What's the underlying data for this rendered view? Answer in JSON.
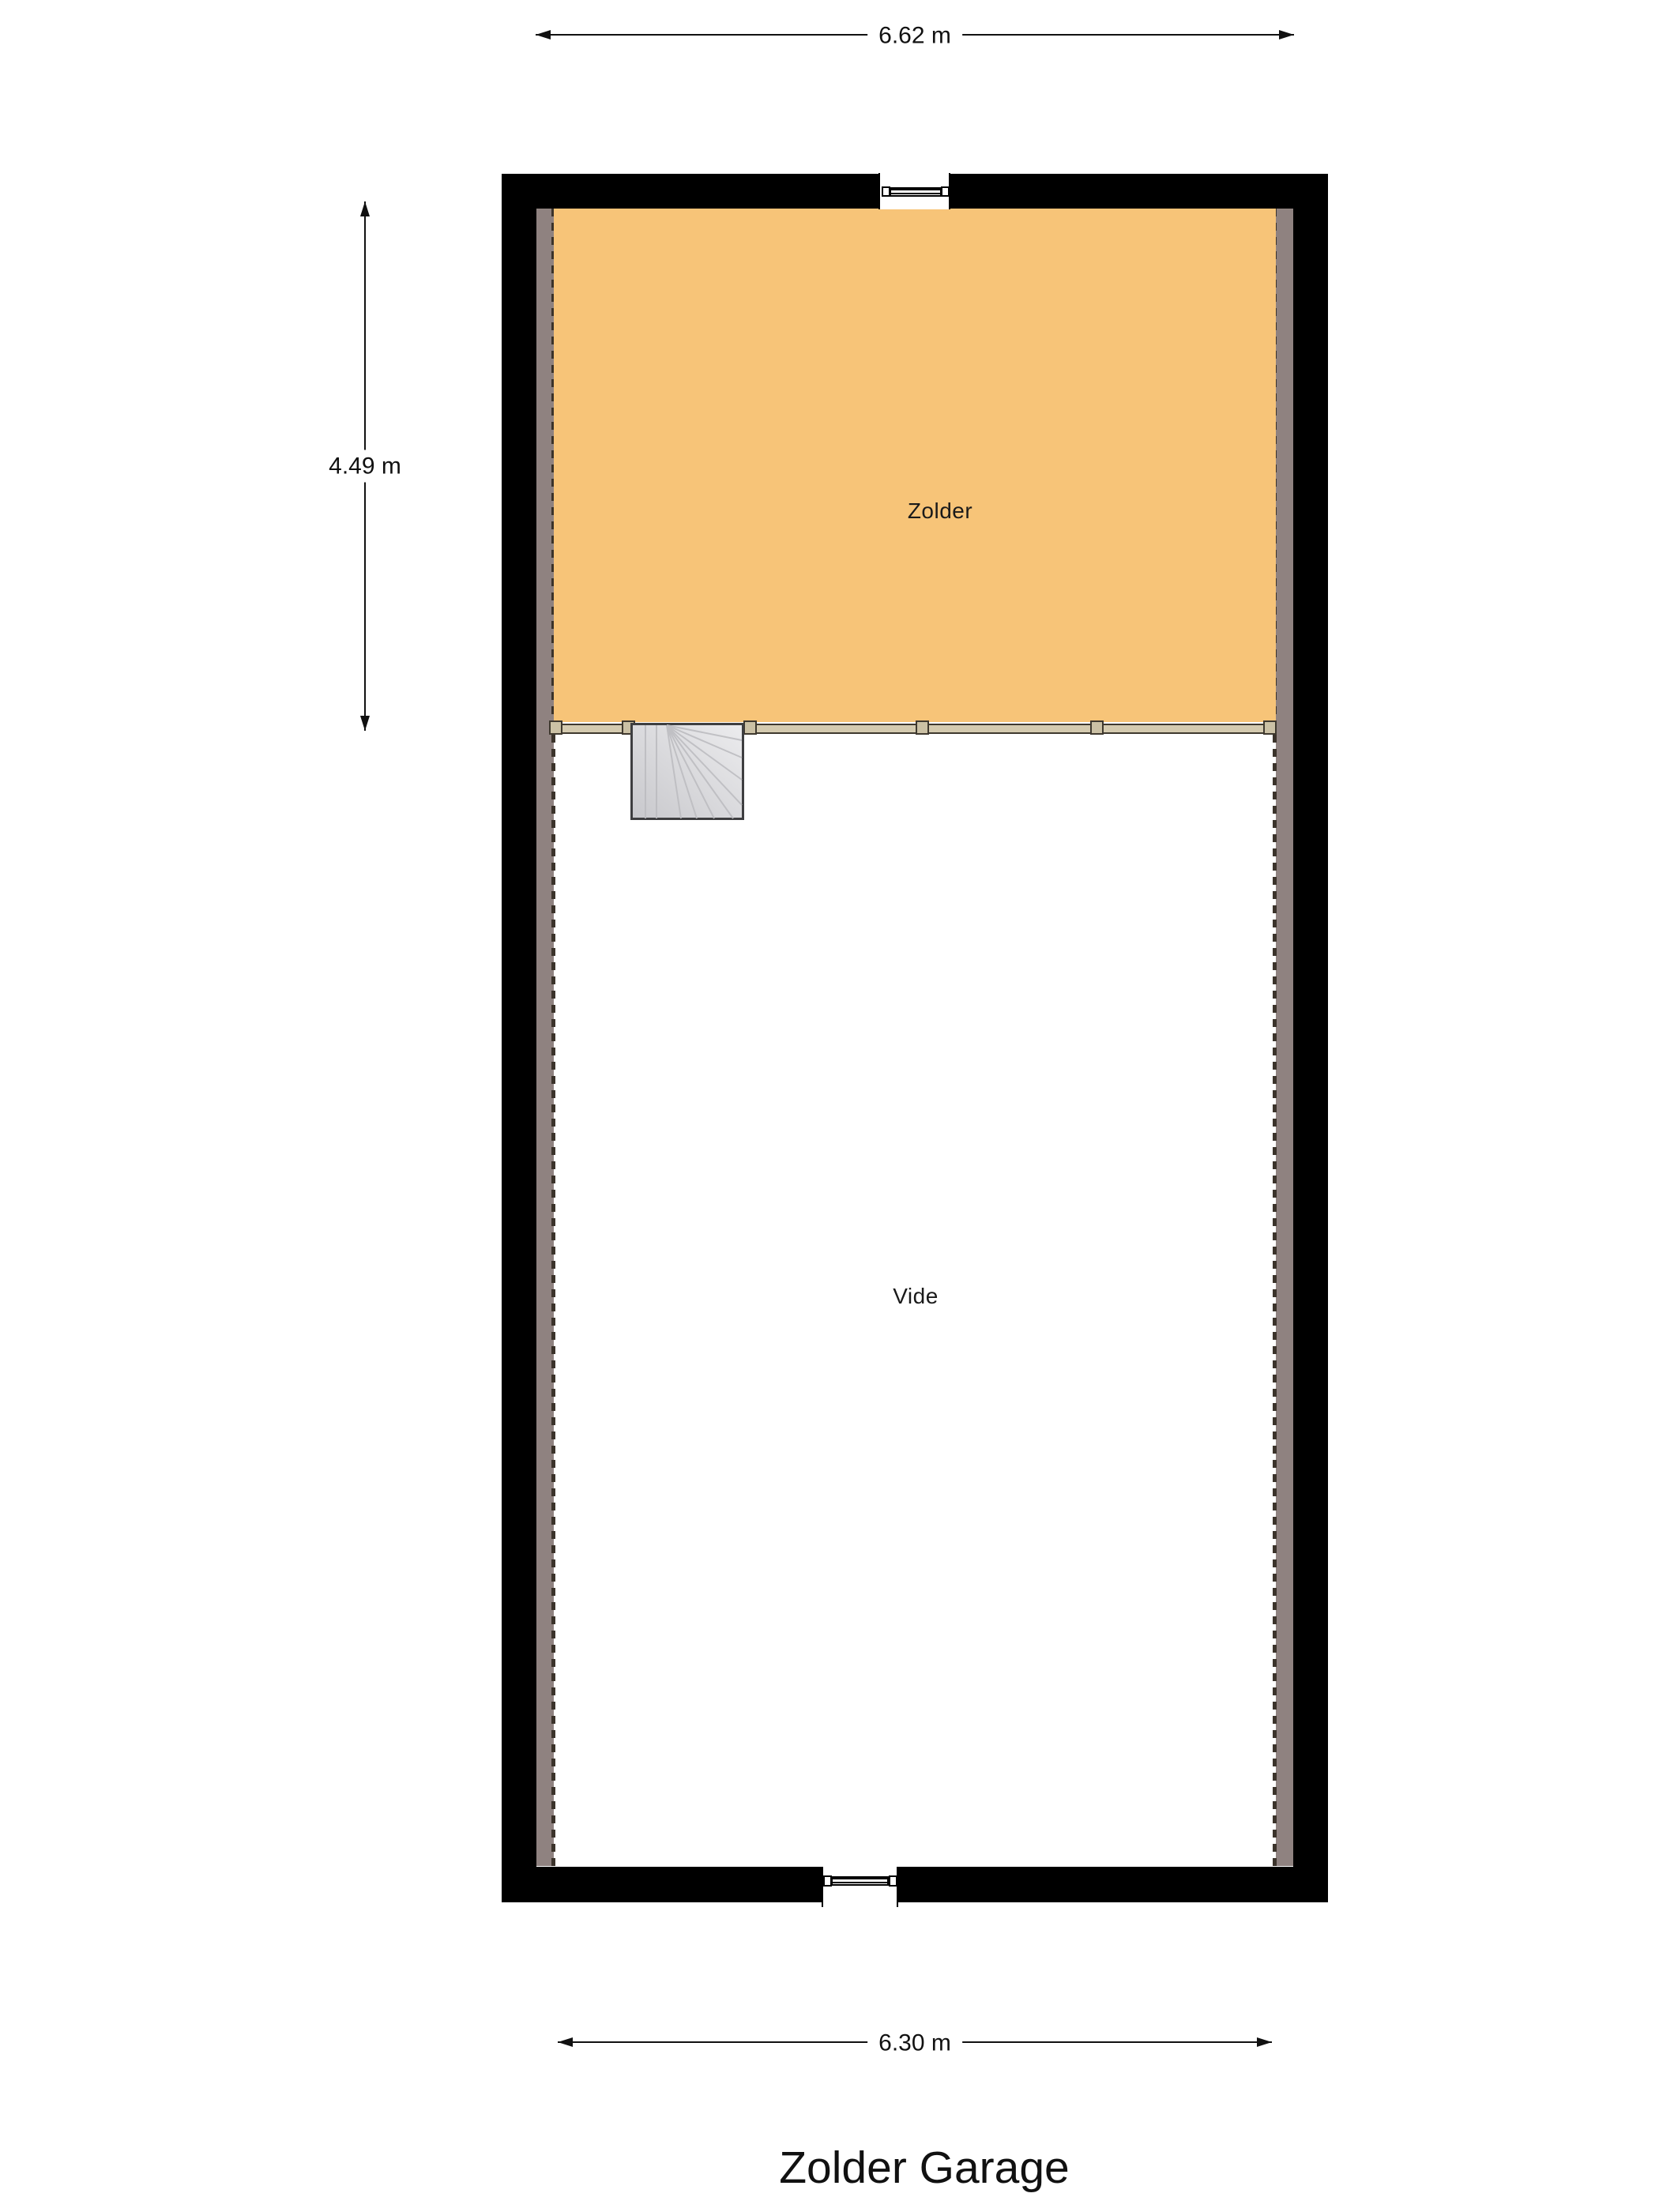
{
  "title": "Zolder Garage",
  "dimensions": {
    "top": {
      "label": "6.62 m",
      "orientation": "horizontal"
    },
    "left": {
      "label": "4.49 m",
      "orientation": "vertical"
    },
    "bottom": {
      "label": "6.30 m",
      "orientation": "horizontal"
    }
  },
  "rooms": {
    "zolder": {
      "label": "Zolder",
      "fill": "#F7C478"
    },
    "vide": {
      "label": "Vide",
      "fill": "#FFFFFF"
    }
  },
  "features": {
    "staircase": "winder-staircase-top-left-of-vide",
    "windows": [
      "top-wall-window",
      "bottom-wall-window"
    ],
    "railing_posts": 6
  },
  "colors": {
    "wall": "#000000",
    "wall_lining": "#8F8280",
    "lining_dash": "#3B332B",
    "beam": "#D5CBB0",
    "beam_post": "#CBC1A5",
    "stair_light": "#ECECEE",
    "stair_dark": "#C8C8CC",
    "text": "#111111"
  }
}
